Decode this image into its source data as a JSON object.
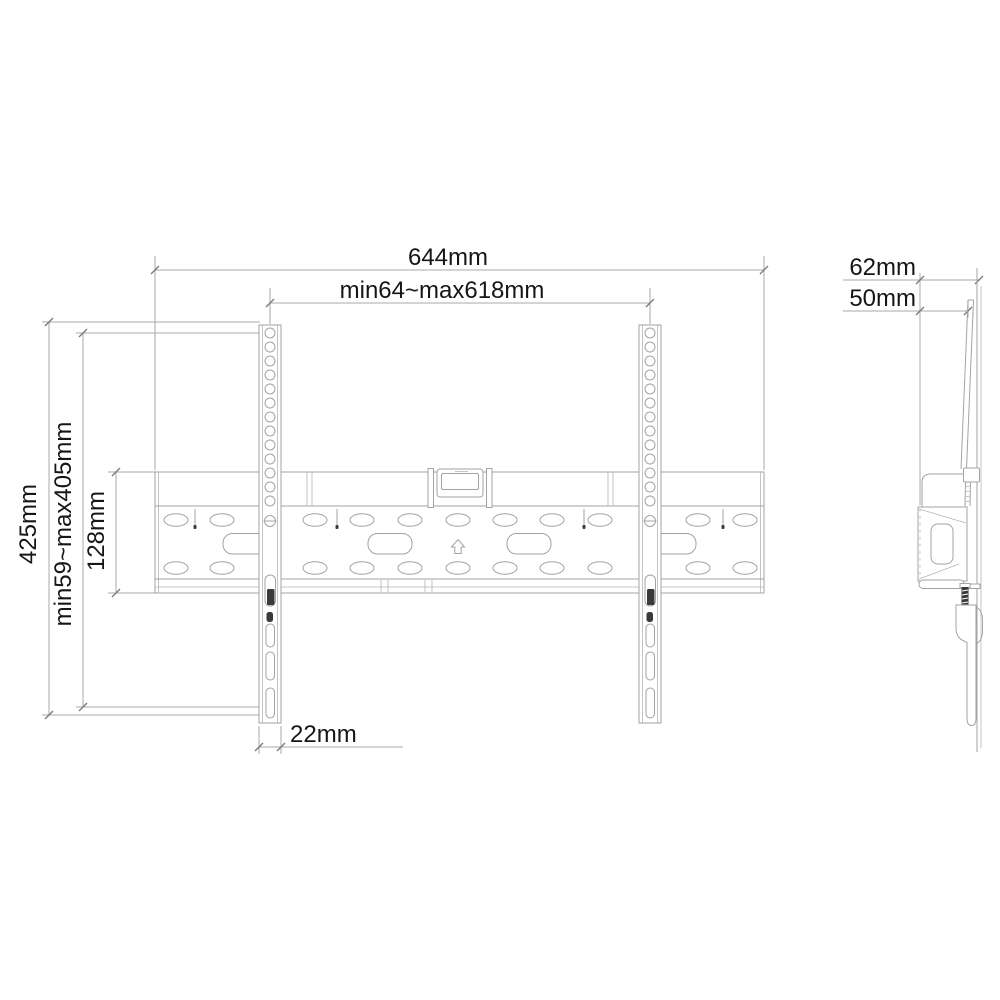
{
  "drawing": {
    "type": "tv-wall-mount-bracket-dimension-drawing",
    "views": {
      "front": {
        "overall_width": "644mm",
        "rail_spacing_range": "min64~max618mm",
        "overall_height": "425mm",
        "vesa_height_range": "min59~max405mm",
        "plate_height": "128mm",
        "rail_width": "22mm"
      },
      "side": {
        "depth_total": "62mm",
        "depth_to_rail": "50mm"
      }
    },
    "line_color": "#a3a3a3",
    "text_color": "#161616",
    "background_color": "#ffffff"
  }
}
